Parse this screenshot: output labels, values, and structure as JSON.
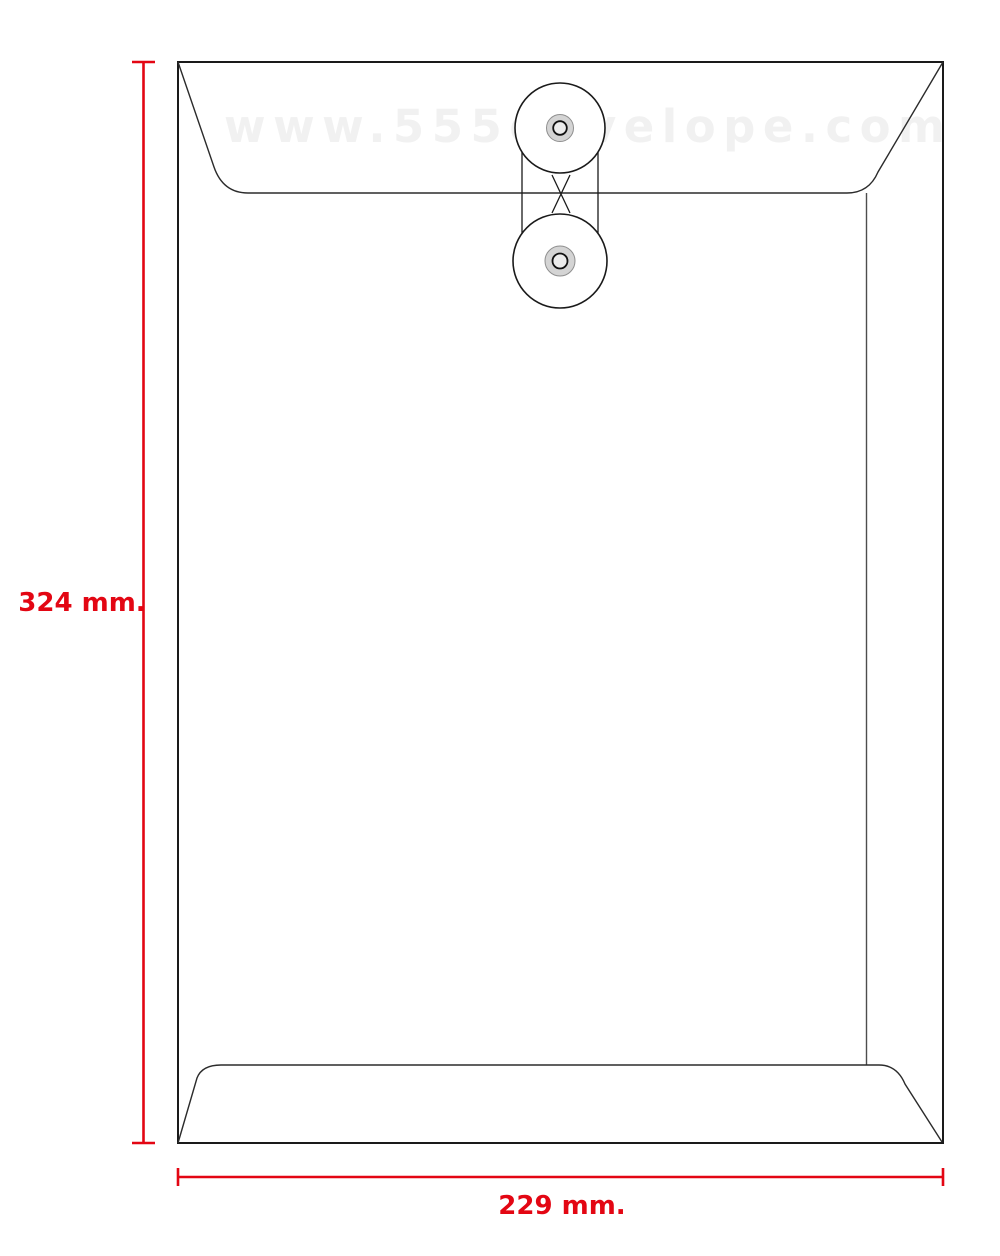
{
  "page": {
    "background": "#ffffff",
    "description": "Technical diagram of an open-end string-and-button envelope with dimension annotations"
  },
  "watermark": {
    "text": "www.555envelope.com",
    "color": "#f1f1f1"
  },
  "envelope": {
    "type": "string-and-button-envelope",
    "height_label": "324 mm.",
    "width_label": "229 mm."
  },
  "colors": {
    "dimension_red": "#e30613",
    "outline_black": "#1a1a1a",
    "fold_gray": "#4d4d4d",
    "button_gray": "#d4d4d4",
    "watermark_gray": "#f1f1f1"
  }
}
